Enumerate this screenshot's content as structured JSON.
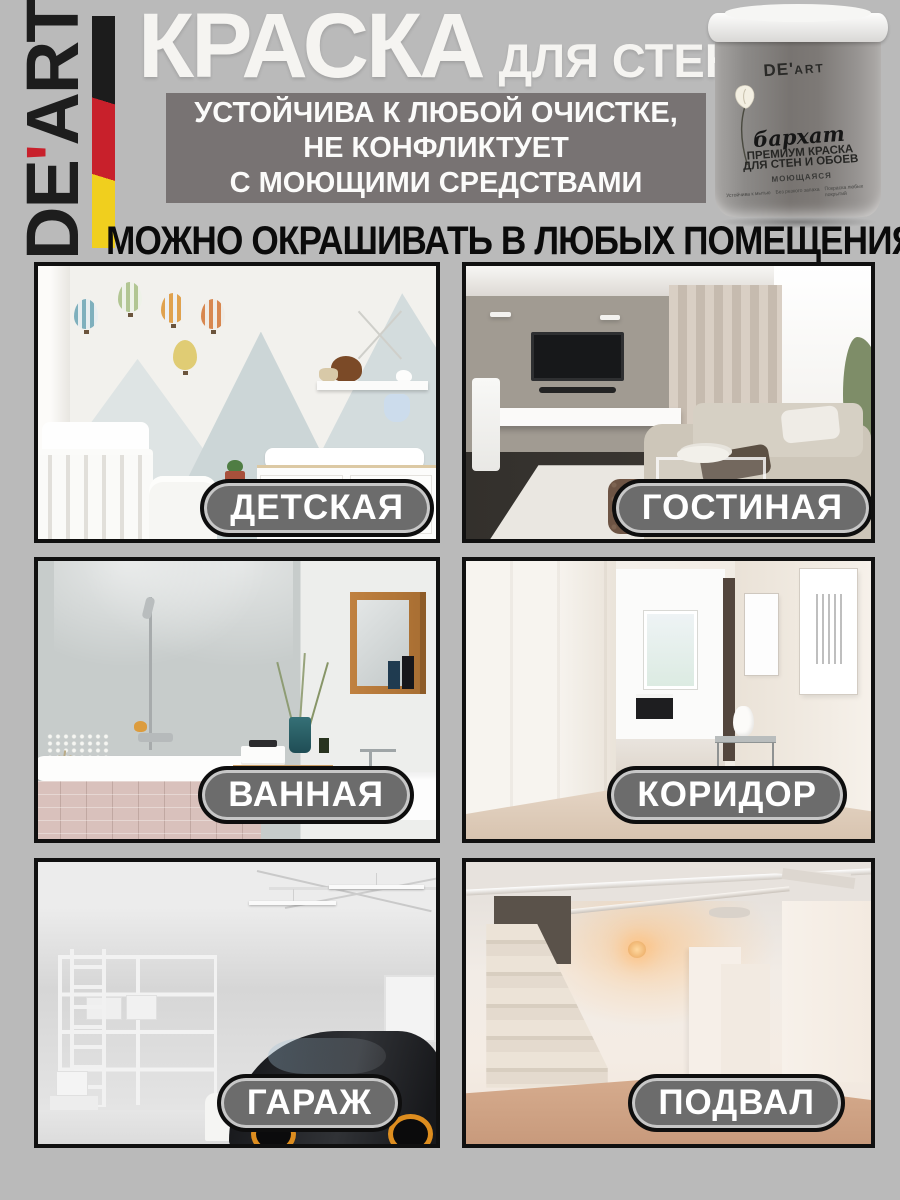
{
  "brand": {
    "prefix": "DE",
    "apostrophe": "'",
    "suffix": "ART"
  },
  "header": {
    "title": "КРАСКА",
    "subtitle": "ДЛЯ СТЕН",
    "claim_lines": [
      "УСТОЙЧИВА К ЛЮБОЙ ОЧИСТКЕ,",
      "НЕ КОНФЛИКТУЕТ",
      "С МОЮЩИМИ СРЕДСТВАМИ"
    ]
  },
  "can": {
    "brand_prefix": "DE'",
    "brand_suffix": "ART",
    "series": "бархат",
    "type_line1": "ПРЕМИУМ КРАСКА",
    "type_line2": "ДЛЯ СТЕН И ОБОЕВ",
    "washable": "МОЮЩАЯСЯ",
    "features": [
      "Устойчива к мытью",
      "Без резкого запаха",
      "Покраска любых покрытий"
    ]
  },
  "section": {
    "heading": "МОЖНО ОКРАШИВАТЬ В ЛЮБЫХ ПОМЕЩЕНИЯХ"
  },
  "rooms": [
    {
      "label": "ДЕТСКАЯ"
    },
    {
      "label": "ГОСТИНАЯ"
    },
    {
      "label": "ВАННАЯ"
    },
    {
      "label": "КОРИДОР"
    },
    {
      "label": "ГАРАЖ"
    },
    {
      "label": "ПОДВАЛ"
    }
  ],
  "colors": {
    "background": "#bababa",
    "claim_box": "#787373",
    "label_pill": "#6c6c6c",
    "flag_black": "#1c1c1c",
    "flag_red": "#c8202b",
    "flag_yellow": "#f0cf1e",
    "title_text": "#f5f4f1",
    "heading_text": "#0b0b0b"
  }
}
